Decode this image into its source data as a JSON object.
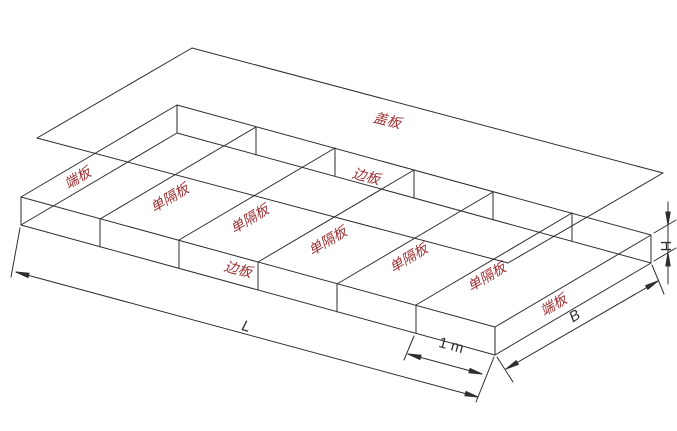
{
  "diagram": {
    "kind": "isometric-wireframe-drawing",
    "subject": "gabion box panel assembly with lifted cover",
    "compartment_count": 6,
    "labels": {
      "cover_plate": "盖板",
      "end_plate_left": "端板",
      "end_plate_right": "端板",
      "side_plate_back": "边板",
      "side_plate_front": "边板",
      "partitions": [
        "单隔板",
        "单隔板",
        "单隔板",
        "单隔板",
        "单隔板"
      ]
    },
    "dimensions": {
      "length": "L",
      "width": "B",
      "height": "H",
      "partition_spacing": "1 m"
    },
    "colors": {
      "line": "#2e2e2e",
      "label_red": "#9e3133",
      "dim_text": "#2e2e2e",
      "background": "#ffffff"
    }
  }
}
